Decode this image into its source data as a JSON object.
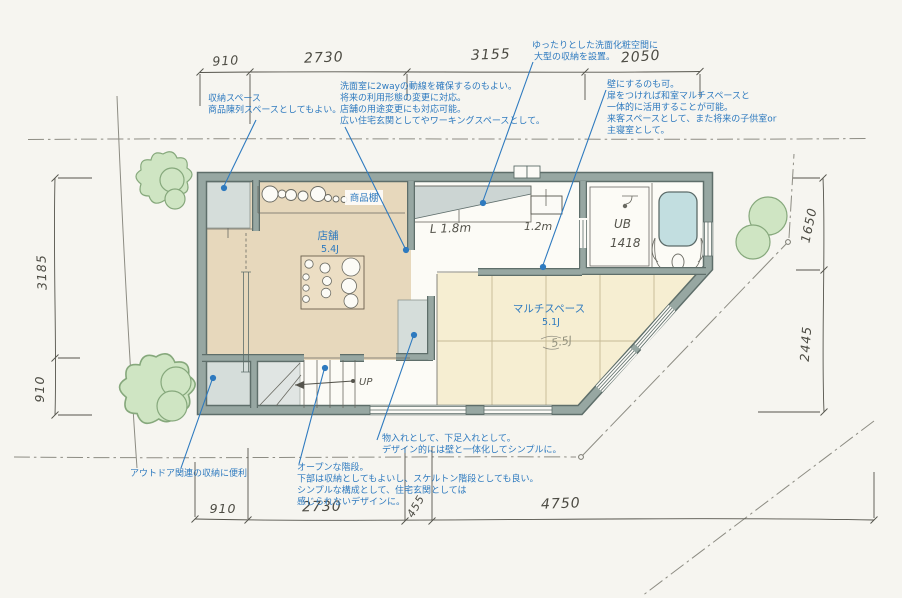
{
  "colors": {
    "annotation_blue": "#2e7abf",
    "wall": "#97a7a2",
    "shop_floor": "#e7d8bc",
    "multi_floor": "#f6eed2",
    "closet_gray": "#d5ddda",
    "bathtub_blue": "#c2dee0",
    "tree_green": "#cfe5c3",
    "paper": "#f6f5f0"
  },
  "dimensions": {
    "top": [
      "910",
      "2730",
      "3155",
      "2050"
    ],
    "bottom": [
      "910",
      "2730",
      "455",
      "4750"
    ],
    "left": [
      "3185",
      "910"
    ],
    "right": [
      "1650",
      "2445"
    ]
  },
  "rooms": {
    "shop": {
      "name": "店舗",
      "area": "5.4J"
    },
    "multi": {
      "name": "マルチスペース",
      "area": "5.1J",
      "pencil_note": "5.5J"
    },
    "unit_bath": {
      "name": "UB",
      "size": "1418"
    }
  },
  "labels": {
    "shelf": "商品棚",
    "counter": "L 1.8m",
    "basin": "1.2m",
    "stairs_up": "UP"
  },
  "annotations": {
    "storage_top": {
      "lines": [
        "収納スペース",
        "商品陳列スペースとしてもよい。"
      ]
    },
    "washroom_2way": {
      "lines": [
        "洗面室に2wayの動線を確保するのもよい。",
        "将来の利用形態の変更に対応。",
        "店舗の用途変更にも対応可能。",
        "広い住宅玄関としてやワーキングスペースとして。"
      ]
    },
    "vanity": {
      "lines": [
        "ゆったりとした洗面化粧空間に",
        "大型の収納を設置。"
      ]
    },
    "wall_option": {
      "lines": [
        "壁にするのも可。",
        "扉をつければ和室マルチスペースと",
        "一体的に活用することが可能。",
        "来客スペースとして、また将来の子供室or",
        "主寝室として。"
      ]
    },
    "outdoor": {
      "lines": [
        "アウトドア関連の収納に便利"
      ]
    },
    "open_stairs": {
      "lines": [
        "オープンな階段。",
        "下部は収納としてもよいし、スケルトン階段としても良い。",
        "シンプルな構成として、住宅玄関としては",
        "感じられないデザインに。"
      ]
    },
    "closet": {
      "lines": [
        "物入れとして、下足入れとして。",
        "デザイン的には壁と一体化してシンプルに。"
      ]
    }
  }
}
